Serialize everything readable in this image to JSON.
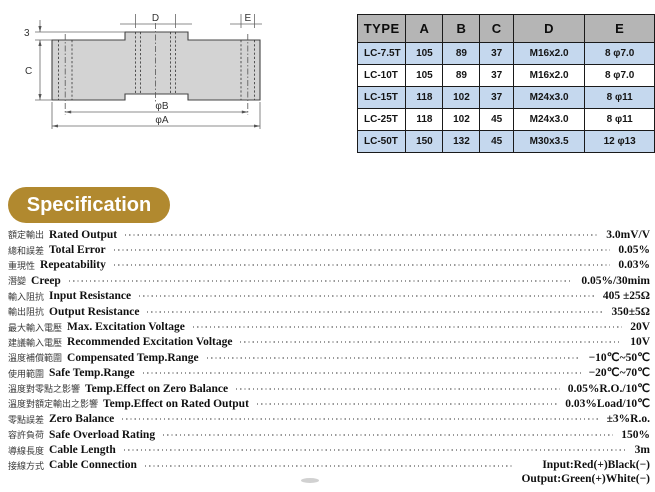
{
  "drawing": {
    "labels": {
      "dim3": "3",
      "dimC": "C",
      "dimD": "D",
      "dimE": "E",
      "dimPhiB": "φB",
      "dimPhiA": "φA"
    }
  },
  "dimension_table": {
    "headers": [
      "TYPE",
      "A",
      "B",
      "C",
      "D",
      "E"
    ],
    "rows": [
      [
        "LC-7.5T",
        "105",
        "89",
        "37",
        "M16x2.0",
        "8 φ7.0"
      ],
      [
        "LC-10T",
        "105",
        "89",
        "37",
        "M16x2.0",
        "8 φ7.0"
      ],
      [
        "LC-15T",
        "118",
        "102",
        "37",
        "M24x3.0",
        "8 φ11"
      ],
      [
        "LC-25T",
        "118",
        "102",
        "45",
        "M24x3.0",
        "8 φ11"
      ],
      [
        "LC-50T",
        "150",
        "132",
        "45",
        "M30x3.5",
        "12 φ13"
      ]
    ]
  },
  "specification": {
    "title": "Specification",
    "rows": [
      {
        "zh": "額定輸出",
        "en": "Rated Output",
        "value": "3.0mV/V"
      },
      {
        "zh": "總和誤差",
        "en": "Total Error",
        "value": "0.05%"
      },
      {
        "zh": "重現性",
        "en": "Repeatability",
        "value": "0.03%"
      },
      {
        "zh": "潛變",
        "en": "Creep",
        "value": "0.05%/30mim"
      },
      {
        "zh": "輸入阻抗",
        "en": "Input Resistance",
        "value": "405 ±25Ω"
      },
      {
        "zh": "輸出阻抗",
        "en": "Output Resistance",
        "value": "350±5Ω"
      },
      {
        "zh": "最大輸入電壓",
        "en": "Max. Excitation Voltage",
        "value": "20V"
      },
      {
        "zh": "建議輸入電壓",
        "en": "Recommended Excitation Voltage",
        "value": "10V"
      },
      {
        "zh": "溫度補償範圍",
        "en": "Compensated Temp.Range",
        "value": "−10℃~50℃"
      },
      {
        "zh": "使用範圍",
        "en": "Safe Temp.Range",
        "value": "−20℃~70℃"
      },
      {
        "zh": "溫度對零點之影響",
        "en": "Temp.Effect on Zero Balance",
        "value": "0.05%R.O./10℃"
      },
      {
        "zh": "溫度對額定輸出之影響",
        "en": "Temp.Effect on Rated Output",
        "value": "0.03%Load/10℃"
      },
      {
        "zh": "零點誤差",
        "en": "Zero Balance",
        "value": "±3%R.o."
      },
      {
        "zh": "容許負荷",
        "en": "Safe Overload Rating",
        "value": "150%"
      },
      {
        "zh": "導線長度",
        "en": "Cable Length",
        "value": "3m"
      },
      {
        "zh": "接線方式",
        "en": "Cable Connection",
        "value": "Input:Red(+)Black(−)",
        "value2": "Output:Green(+)White(−)"
      }
    ]
  },
  "colors": {
    "accent_gold": "#b1892f",
    "table_header_bg": "#b5b5b5",
    "table_row_alt_bg": "#c5d8ee",
    "drawing_fill": "#d3d3d3"
  }
}
